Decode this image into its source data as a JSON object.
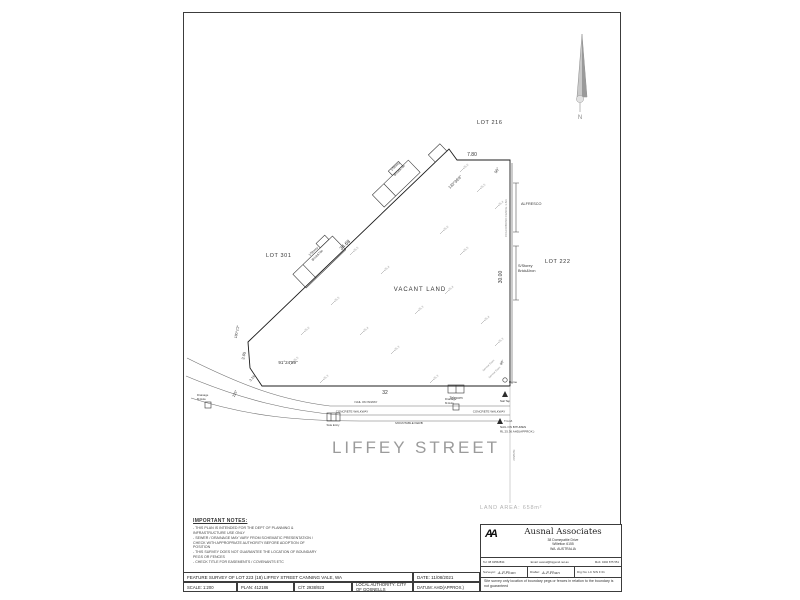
{
  "plan": {
    "lot301": "LOT 301",
    "lot216": "LOT 216",
    "lot222": "LOT 222",
    "vacant_land": "VACANT LAND",
    "street_name": "LIFFEY STREET",
    "land_area": "LAND AREA:  658m²",
    "north_label": "N",
    "dim_top": "7.80",
    "dim_bottom": "32",
    "dim_right": "30.00",
    "dim_diagonal": "34.68",
    "dim_left_a": "3.65",
    "dim_left_b": "3.16",
    "brg_diagonal": "133°36'9\"",
    "brg_left": "180°1'2\"",
    "ang_bottom_left": "91°24'59\"",
    "ang_street": "225°",
    "ang_top_right": "90°",
    "ang_bottom_right": "90°",
    "fence_label": "COLORBOND FENCE 1.8m",
    "alfresco": "ALFRESCO",
    "bldg1_l1": "1/Storey",
    "bldg1_l2": "Brick&Tile",
    "bldg2_l1": "1/Storey",
    "bldg2_l2": "Brick&Tile",
    "bldg3_l1": "S/Storey",
    "bldg3_l2": "Brick&Iron",
    "telecom": "Telecom",
    "nail_walkway": "NAIL ON W/WAY",
    "walkway": "CONCRETE WALKWAY",
    "mountable_kerb": "MOUNTABLE KERB",
    "side_entry": "Side Entry",
    "drain_l1": "Drainage",
    "drain_l2": "M.Hole",
    "dome": "Dome",
    "nail_tap": "Nail Tap",
    "tgm": "T.G.M.",
    "bench_l1": "NAIL ON BITUMEN",
    "bench_l2": "RL 25.36 AHD(APPROX.)",
    "sewer": "SEWER",
    "service_point": "Service Point",
    "spots": [
      {
        "x": 462,
        "y": 170,
        "v": "25.6"
      },
      {
        "x": 479,
        "y": 190,
        "v": "25.5"
      },
      {
        "x": 497,
        "y": 207,
        "v": "25.4"
      },
      {
        "x": 442,
        "y": 232,
        "v": "25.6"
      },
      {
        "x": 462,
        "y": 253,
        "v": "25.5"
      },
      {
        "x": 352,
        "y": 253,
        "v": "25.5"
      },
      {
        "x": 383,
        "y": 272,
        "v": "25.4"
      },
      {
        "x": 447,
        "y": 292,
        "v": "25.4"
      },
      {
        "x": 333,
        "y": 303,
        "v": "25.5"
      },
      {
        "x": 417,
        "y": 312,
        "v": "25.3"
      },
      {
        "x": 483,
        "y": 322,
        "v": "25.4"
      },
      {
        "x": 303,
        "y": 333,
        "v": "25.6"
      },
      {
        "x": 362,
        "y": 333,
        "v": "25.4"
      },
      {
        "x": 393,
        "y": 352,
        "v": "25.3"
      },
      {
        "x": 292,
        "y": 363,
        "v": "25.5"
      },
      {
        "x": 497,
        "y": 344,
        "v": "25.3"
      },
      {
        "x": 322,
        "y": 381,
        "v": "25.3"
      },
      {
        "x": 432,
        "y": 381,
        "v": "25.3"
      }
    ]
  },
  "notes": {
    "title": "IMPORTANT NOTES:",
    "items": [
      "- THIS PLAN IS INTENDED FOR THE DEPT OF PLANNING & INFRASTRUCTURE USE ONLY",
      "- SEWER / DRAINAGE MAY VARY FROM SCHEMATIC PRESENTATION / CHECK WITH APPROPRIATE AUTHORITY BEFORE ADOPTION OF POSITION",
      "- THIS SURVEY DOES NOT GUARANTEE THE LOCATION OF BOUNDARY PEGS OR FENCES",
      "- CHECK TITLE FOR EASEMENTS / COVENANTS ETC"
    ]
  },
  "titleblock": {
    "title": "FEATURE SURVEY OF  LOT 223 (18) LIFFEY STREET CANNING VALE, WA",
    "date": "DATE: 11/08/2021",
    "scale": "SCALE: 1:200",
    "plan_no": "PLAN: 412186",
    "ct": "C/T: 2938/923",
    "authority": "LOCAL AUTHORITY: CITY OF GOSNELLS",
    "datum": "DATUM: AHD(APPROX.)"
  },
  "firm": {
    "logo": "AA",
    "name": "Ausnal Associates",
    "addr1": "38 Domepattie Drive",
    "addr2": "Willetton 6155",
    "addr3": "WA. AUSTRALIA",
    "tel": "Tel: 08 92552834",
    "email": "Email: ausnal@bigpond.net.au",
    "mob": "Mob: 0402 875 551",
    "surveyor_label": "Surveyor:",
    "surveyor_sig": "A.F.Phan",
    "drafter_label": "Drafter:",
    "drafter_sig": "A.F.Phan",
    "drg_no": "Drg No: LC N/N F 01",
    "site_note": "Site survey only location of boundary pegs or fences in relation to the boundary is not guaranteed"
  }
}
